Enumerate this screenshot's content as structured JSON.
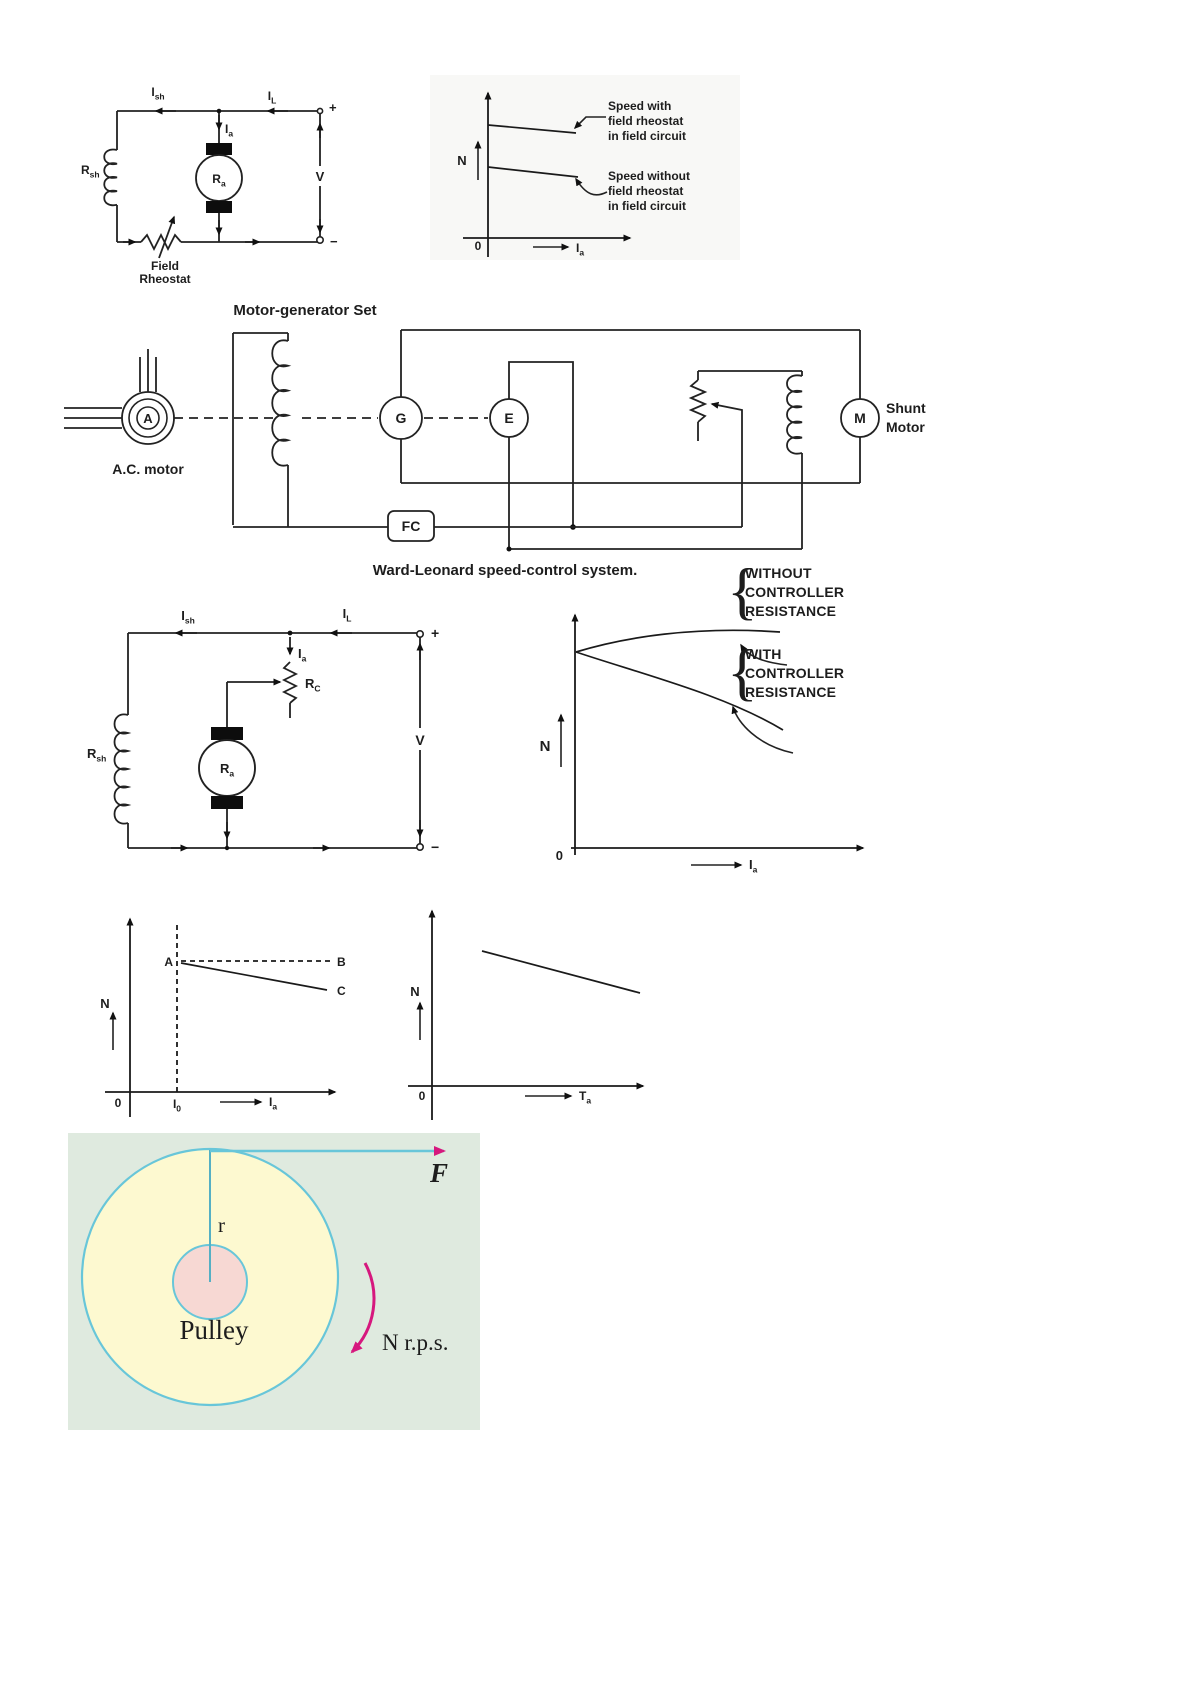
{
  "page": {
    "background": "#ffffff"
  },
  "colors": {
    "ink": "#1d1d1d",
    "scan_shade": "#f3f2ee",
    "magenta": "#d6187e",
    "cyan": "#68c6d9",
    "panel_bg": "#dfeadf",
    "wheel_fill": "#fdf9d0",
    "hub_fill": "#f7d8d3",
    "wheel_text": "#4a4a28"
  },
  "figure1": {
    "i_sh": {
      "base": "I",
      "sub": "sh"
    },
    "i_l": {
      "base": "I",
      "sub": "L"
    },
    "i_a": {
      "base": "I",
      "sub": "a"
    },
    "r_sh": {
      "base": "R",
      "sub": "sh"
    },
    "r_a": {
      "base": "R",
      "sub": "a"
    },
    "v": "V",
    "plus": "+",
    "minus": "−",
    "field_rheostat": [
      "Field",
      "Rheostat"
    ]
  },
  "figure2": {
    "y_label": "N",
    "origin": "0",
    "x_label": {
      "base": "I",
      "sub": "a"
    },
    "with_lines": [
      "Speed with",
      "field rheostat",
      "in field circuit"
    ],
    "without_lines": [
      "Speed without",
      "field rheostat",
      "in field circuit"
    ]
  },
  "figure3": {
    "title": "Motor-generator Set",
    "ac_motor_symbol": "A",
    "ac_motor_label": "A.C. motor",
    "generator": "G",
    "exciter": "E",
    "motor": "M",
    "shunt_motor": [
      "Shunt",
      "Motor"
    ],
    "fc": "FC",
    "caption": "Ward-Leonard speed-control system."
  },
  "figure4": {
    "i_sh": {
      "base": "I",
      "sub": "sh"
    },
    "i_l": {
      "base": "I",
      "sub": "L"
    },
    "i_a": {
      "base": "I",
      "sub": "a"
    },
    "r_c": {
      "base": "R",
      "sub": "C"
    },
    "r_sh": {
      "base": "R",
      "sub": "sh"
    },
    "r_a": {
      "base": "R",
      "sub": "a"
    },
    "v": "V",
    "plus": "+",
    "minus": "−"
  },
  "figure5": {
    "y_label": "N",
    "origin": "0",
    "x_label": {
      "base": "I",
      "sub": "a"
    },
    "brace": "{",
    "without_lines": [
      "WITHOUT",
      "CONTROLLER",
      "RESISTANCE"
    ],
    "with_lines": [
      "WITH",
      "CONTROLLER",
      "RESISTANCE"
    ]
  },
  "figure6": {
    "y_label": "N",
    "origin": "0",
    "x_tick": {
      "base": "I",
      "sub": "0"
    },
    "x_label": {
      "base": "I",
      "sub": "a"
    },
    "point_a": "A",
    "point_b": "B",
    "point_c": "C"
  },
  "figure7": {
    "y_label": "N",
    "origin": "0",
    "x_label": {
      "base": "T",
      "sub": "a"
    }
  },
  "figure8": {
    "radius_label": "r",
    "pulley_label": "Pulley",
    "force_label": "F",
    "speed_label": "N r.p.s."
  }
}
